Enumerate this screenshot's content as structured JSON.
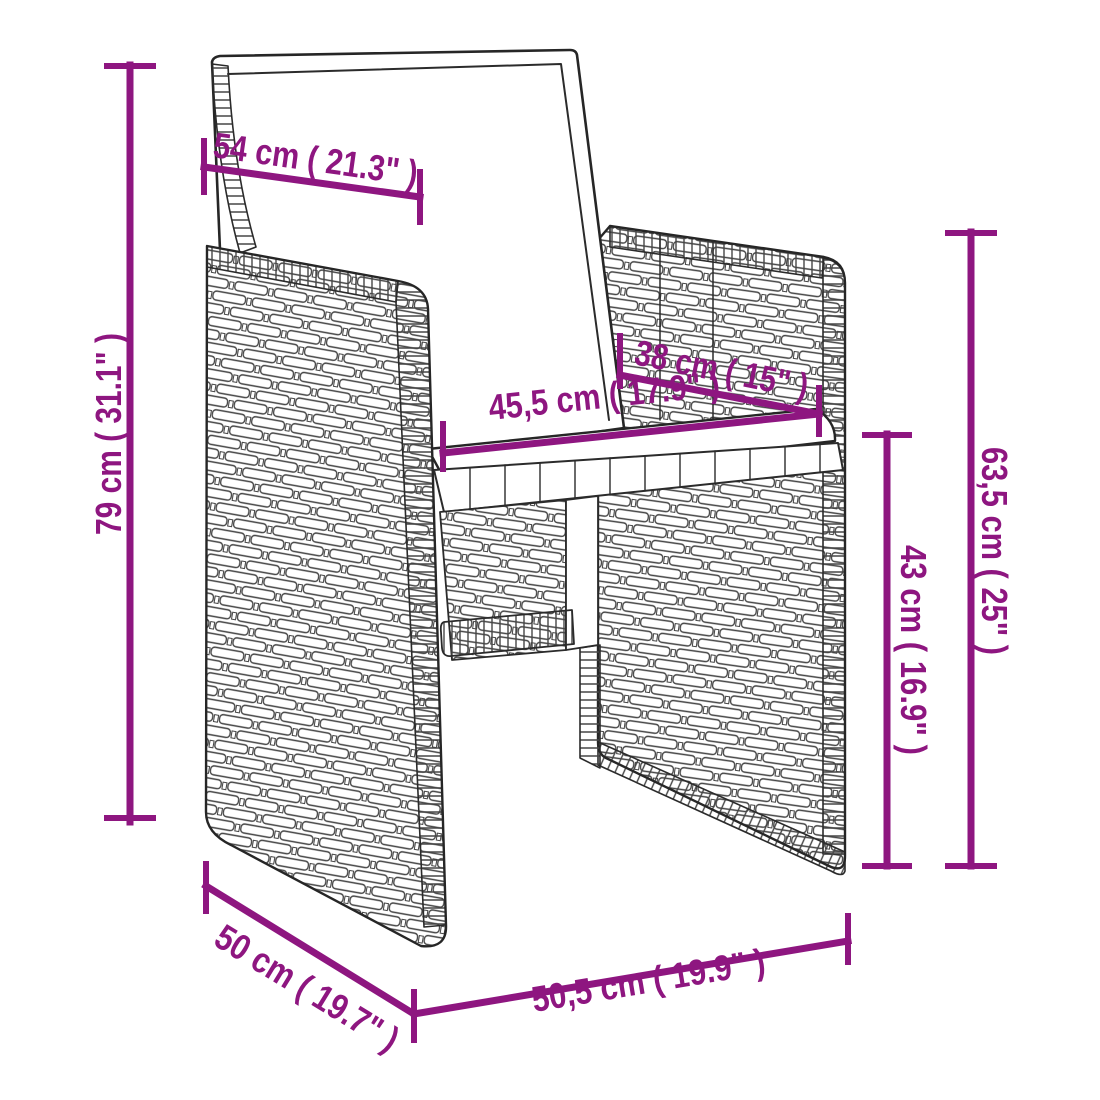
{
  "page": {
    "background": "#ffffff"
  },
  "diagram": {
    "type": "product-dimension-diagram",
    "subject": "poly-rattan garden chair with cushions",
    "accent_color": "#8E1680",
    "line_art_color": "#2b2b2b",
    "dimensions": [
      {
        "id": "dim-54",
        "label": "54 cm ( 21.3\" )",
        "value_cm": 54,
        "value_in": 21.3,
        "placement": "top-left-diagonal"
      },
      {
        "id": "dim-79",
        "label": "79 cm ( 31.1\" )",
        "value_cm": 79,
        "value_in": 31.1,
        "placement": "left-vertical"
      },
      {
        "id": "dim-38",
        "label": "38 cm ( 15\" )",
        "value_cm": 38,
        "value_in": 15,
        "placement": "seat-back-diagonal"
      },
      {
        "id": "dim-45-5",
        "label": "45,5 cm ( 17.9\" )",
        "value_cm": 45.5,
        "value_in": 17.9,
        "placement": "seat-front-diagonal"
      },
      {
        "id": "dim-63-5",
        "label": "63,5 cm ( 25\" )",
        "value_cm": 63.5,
        "value_in": 25,
        "placement": "right-outer-vertical"
      },
      {
        "id": "dim-43",
        "label": "43 cm ( 16.9\" )",
        "value_cm": 43,
        "value_in": 16.9,
        "placement": "right-inner-vertical"
      },
      {
        "id": "dim-50",
        "label": "50 cm ( 19.7\" )",
        "value_cm": 50,
        "value_in": 19.7,
        "placement": "bottom-left-diagonal"
      },
      {
        "id": "dim-50-5",
        "label": "50,5 cm ( 19.9\" )",
        "value_cm": 50.5,
        "value_in": 19.9,
        "placement": "bottom-right-diagonal"
      }
    ]
  }
}
